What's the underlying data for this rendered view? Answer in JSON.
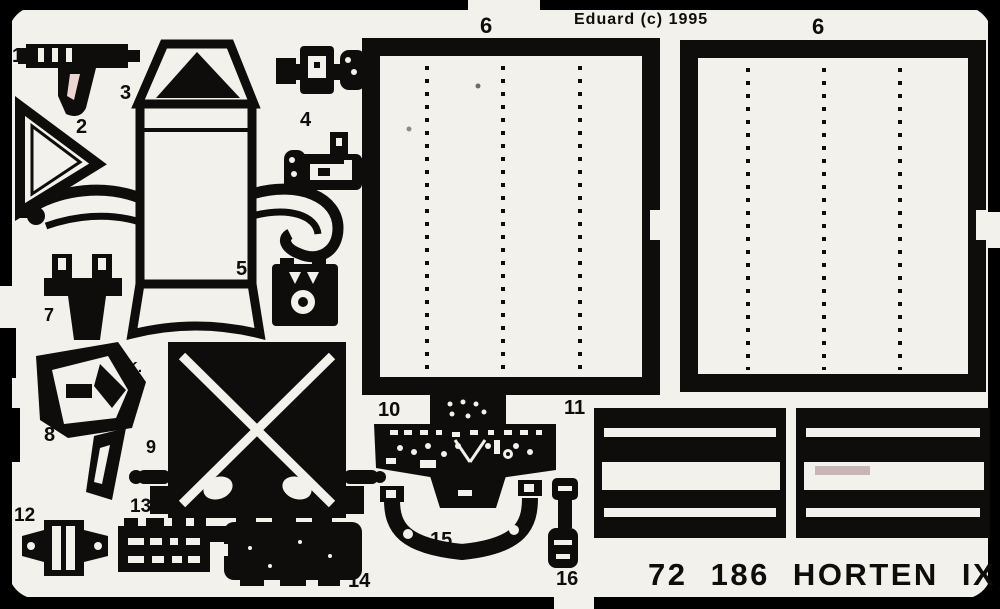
{
  "header": {
    "copyright": "Eduard (c) 1995"
  },
  "footer": {
    "catalog_title": "72 186 HORTEN IX"
  },
  "sheet": {
    "maker_mark": "K.K.",
    "panel_labels": {
      "left": "6",
      "right": "6"
    },
    "part_labels": {
      "p1": "1",
      "p2": "2",
      "p3": "3",
      "p4": "4",
      "p5": "5",
      "p7": "7",
      "p8": "8",
      "p9": "9",
      "p10": "10",
      "p11": "11",
      "p12": "12",
      "p13": "13",
      "p14": "14",
      "p15": "15",
      "p16": "16"
    }
  },
  "colors": {
    "background": "#000000",
    "fret": "#f3f1ec",
    "etch": "#0e0d0b"
  }
}
